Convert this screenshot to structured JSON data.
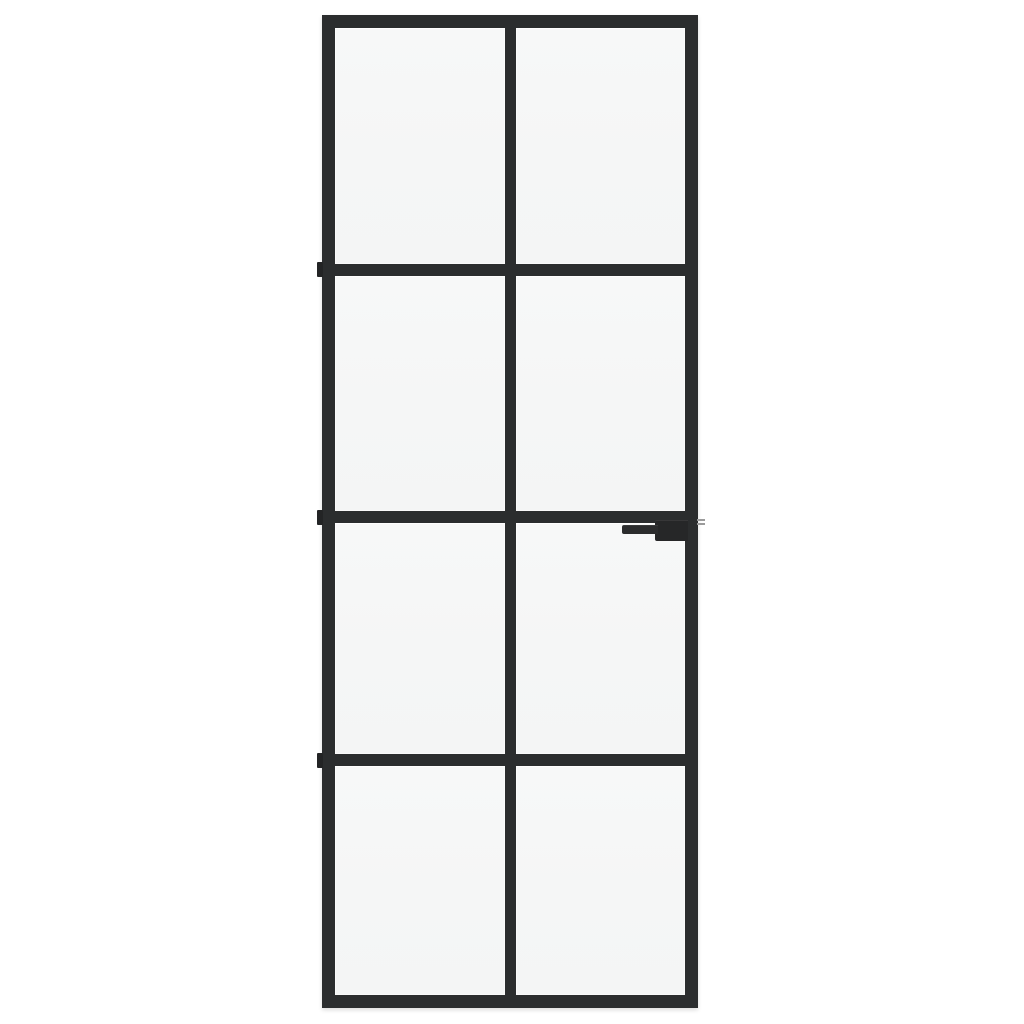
{
  "scene": {
    "background_color": "#ffffff",
    "drop_shadow_color": "rgba(0,0,0,0.14)"
  },
  "door": {
    "frame_color": "#2b2d2e",
    "glass_color": "#f5f6f6",
    "glass_highlight_color": "#ffffff",
    "grid": {
      "columns": 2,
      "rows": 4,
      "pane_count": 8
    },
    "hinges": {
      "count": 3,
      "color": "#232425"
    },
    "handle": {
      "style": "lever",
      "base_color": "#262728",
      "lever_color": "#2b2c2d"
    },
    "latch": {
      "color": "#9b9b9b",
      "line_count": 2
    }
  }
}
